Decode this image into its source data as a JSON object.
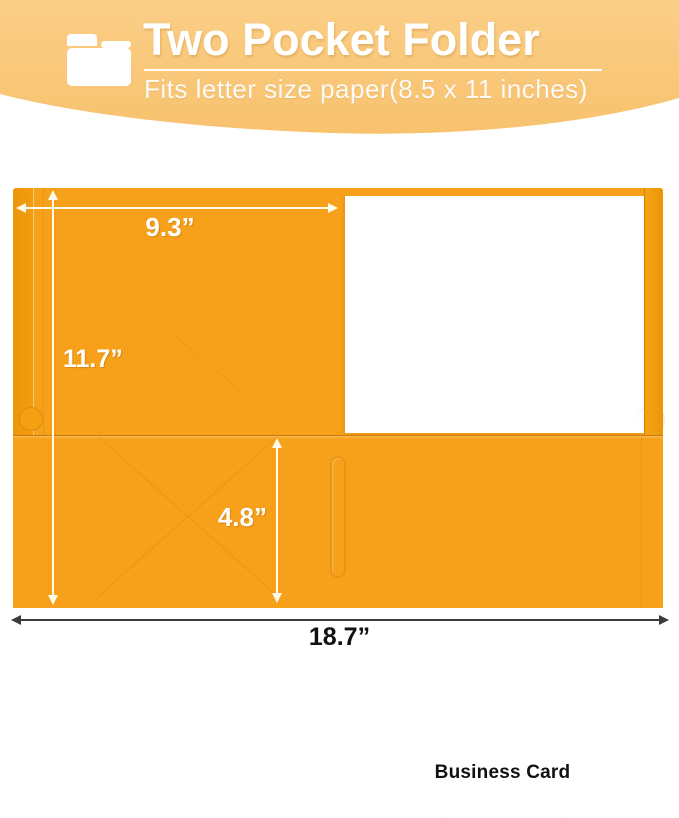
{
  "header": {
    "icon": "folder-icon",
    "title": "Two Pocket Folder",
    "subtitle": "Fits letter size paper(8.5 x 11 inches)"
  },
  "folder": {
    "business_card_label": "Business Card"
  },
  "dimensions": {
    "open_width": "9.3”",
    "height": "11.7”",
    "pocket_depth": "4.8”",
    "total_width": "18.7”"
  },
  "colors": {
    "banner_top": "#FACE87",
    "banner_bottom": "#F8C26E",
    "folder_body": "#F7A11A",
    "folder_spine": "#ED9509",
    "arrow_light": "#FFFBEA",
    "arrow_dark": "#3B3B3B",
    "card_text": "#111111"
  }
}
